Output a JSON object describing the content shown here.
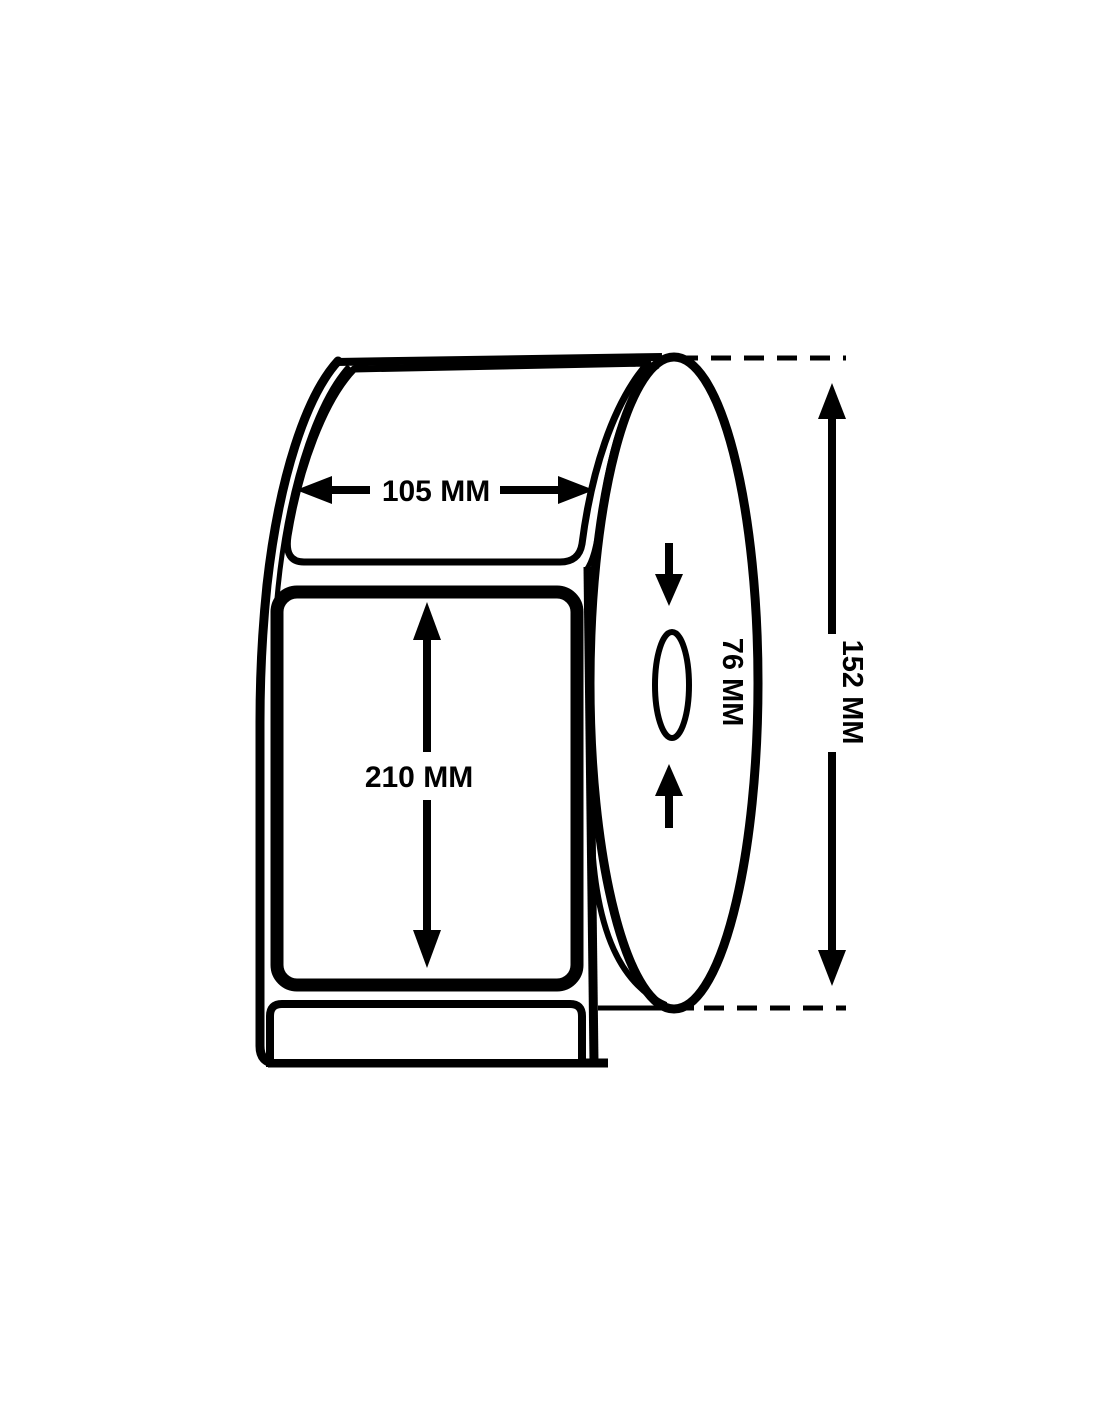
{
  "diagram": {
    "name": "label-roll-dimension-diagram",
    "dimensions": {
      "label_width": "105 MM",
      "label_height": "210 MM",
      "core_diameter": "76 MM",
      "roll_diameter": "152 MM"
    },
    "colors": {
      "line": "#000000",
      "background": "#ffffff"
    }
  }
}
